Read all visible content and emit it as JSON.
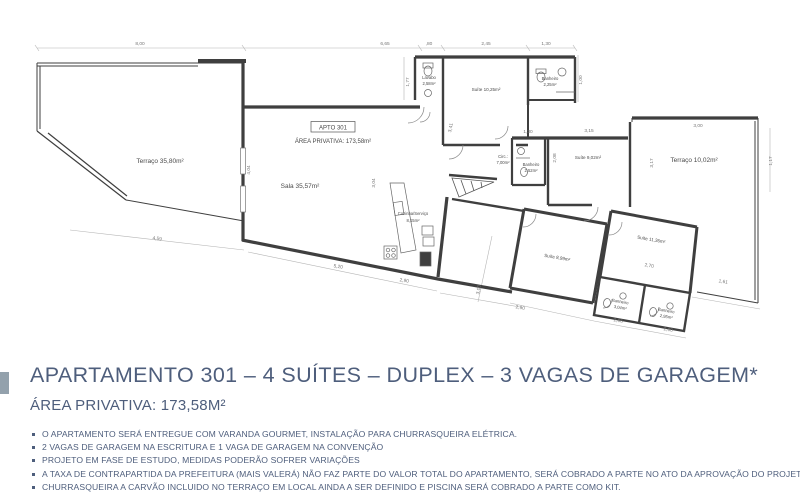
{
  "colors": {
    "heading": "#4e5e7c",
    "accent": "#93a1ac",
    "wall": "#3f3f3f",
    "dim": "#8a8a8a"
  },
  "plan": {
    "rooms": [
      {
        "label": "Terraço 35,80m²"
      },
      {
        "label": "APTO 301"
      },
      {
        "label": "ÁREA PRIVATIVA: 173,58m²"
      },
      {
        "label": "Sala 35,57m²"
      },
      {
        "label": "Lavabo",
        "area": "2,58m²"
      },
      {
        "label": "Suíte 10,25m²"
      },
      {
        "label": "Banheiro",
        "area": "2,25m²"
      },
      {
        "label": "Circ.:",
        "area": "7,00m²"
      },
      {
        "label": "Banheiro",
        "area": "2,52m²"
      },
      {
        "label": "Suíte 9,02m²"
      },
      {
        "label": "Terraço 10,02m²"
      },
      {
        "label": "Cozinha/Serviço",
        "area": "8,15m²"
      },
      {
        "label": "Suíte 8,99m²"
      },
      {
        "label": "Suíte 11,36m²"
      },
      {
        "label": "Banheiro",
        "area": "3,04m²"
      },
      {
        "label": "Banheiro",
        "area": "2,95m²"
      }
    ],
    "dims": [
      "8,00",
      "6,65",
      ",80",
      "2,45",
      "1,30",
      "1,77",
      "1,00",
      "3,41",
      "4,04",
      "3,04",
      "1,30",
      "3,15",
      "3,00",
      "2,08",
      "3,17",
      "4,59",
      "5,20",
      "2,90",
      "3,00",
      "2,90",
      "2,06",
      "2,00",
      "2,70",
      "1,61",
      "1,17"
    ]
  },
  "heading": {
    "title": "APARTAMENTO 301 – 4 SUÍTES – DUPLEX – 3 VAGAS DE GARAGEM*",
    "subtitle": "ÁREA PRIVATIVA: 173,58M²"
  },
  "bullets": [
    "O APARTAMENTO SERÁ ENTREGUE COM VARANDA GOURMET, INSTALAÇÃO PARA CHURRASQUEIRA ELÉTRICA.",
    "2 VAGAS DE GARAGEM NA ESCRITURA E 1 VAGA DE GARAGEM NA CONVENÇÃO",
    "PROJETO EM FASE DE ESTUDO, MEDIDAS PODERÃO SOFRER VARIAÇÕES",
    "A TAXA DE CONTRAPARTIDA DA PREFEITURA (MAIS VALERÁ) NÃO FAZ PARTE DO VALOR TOTAL DO APARTAMENTO, SERÁ COBRADO A PARTE NO ATO DA APROVAÇÃO DO PROJETO.",
    "CHURRASQUEIRA A CARVÃO INCLUIDO NO TERRAÇO EM LOCAL AINDA A SER DEFINIDO E PISCINA SERÁ COBRADO A PARTE COMO KIT."
  ]
}
